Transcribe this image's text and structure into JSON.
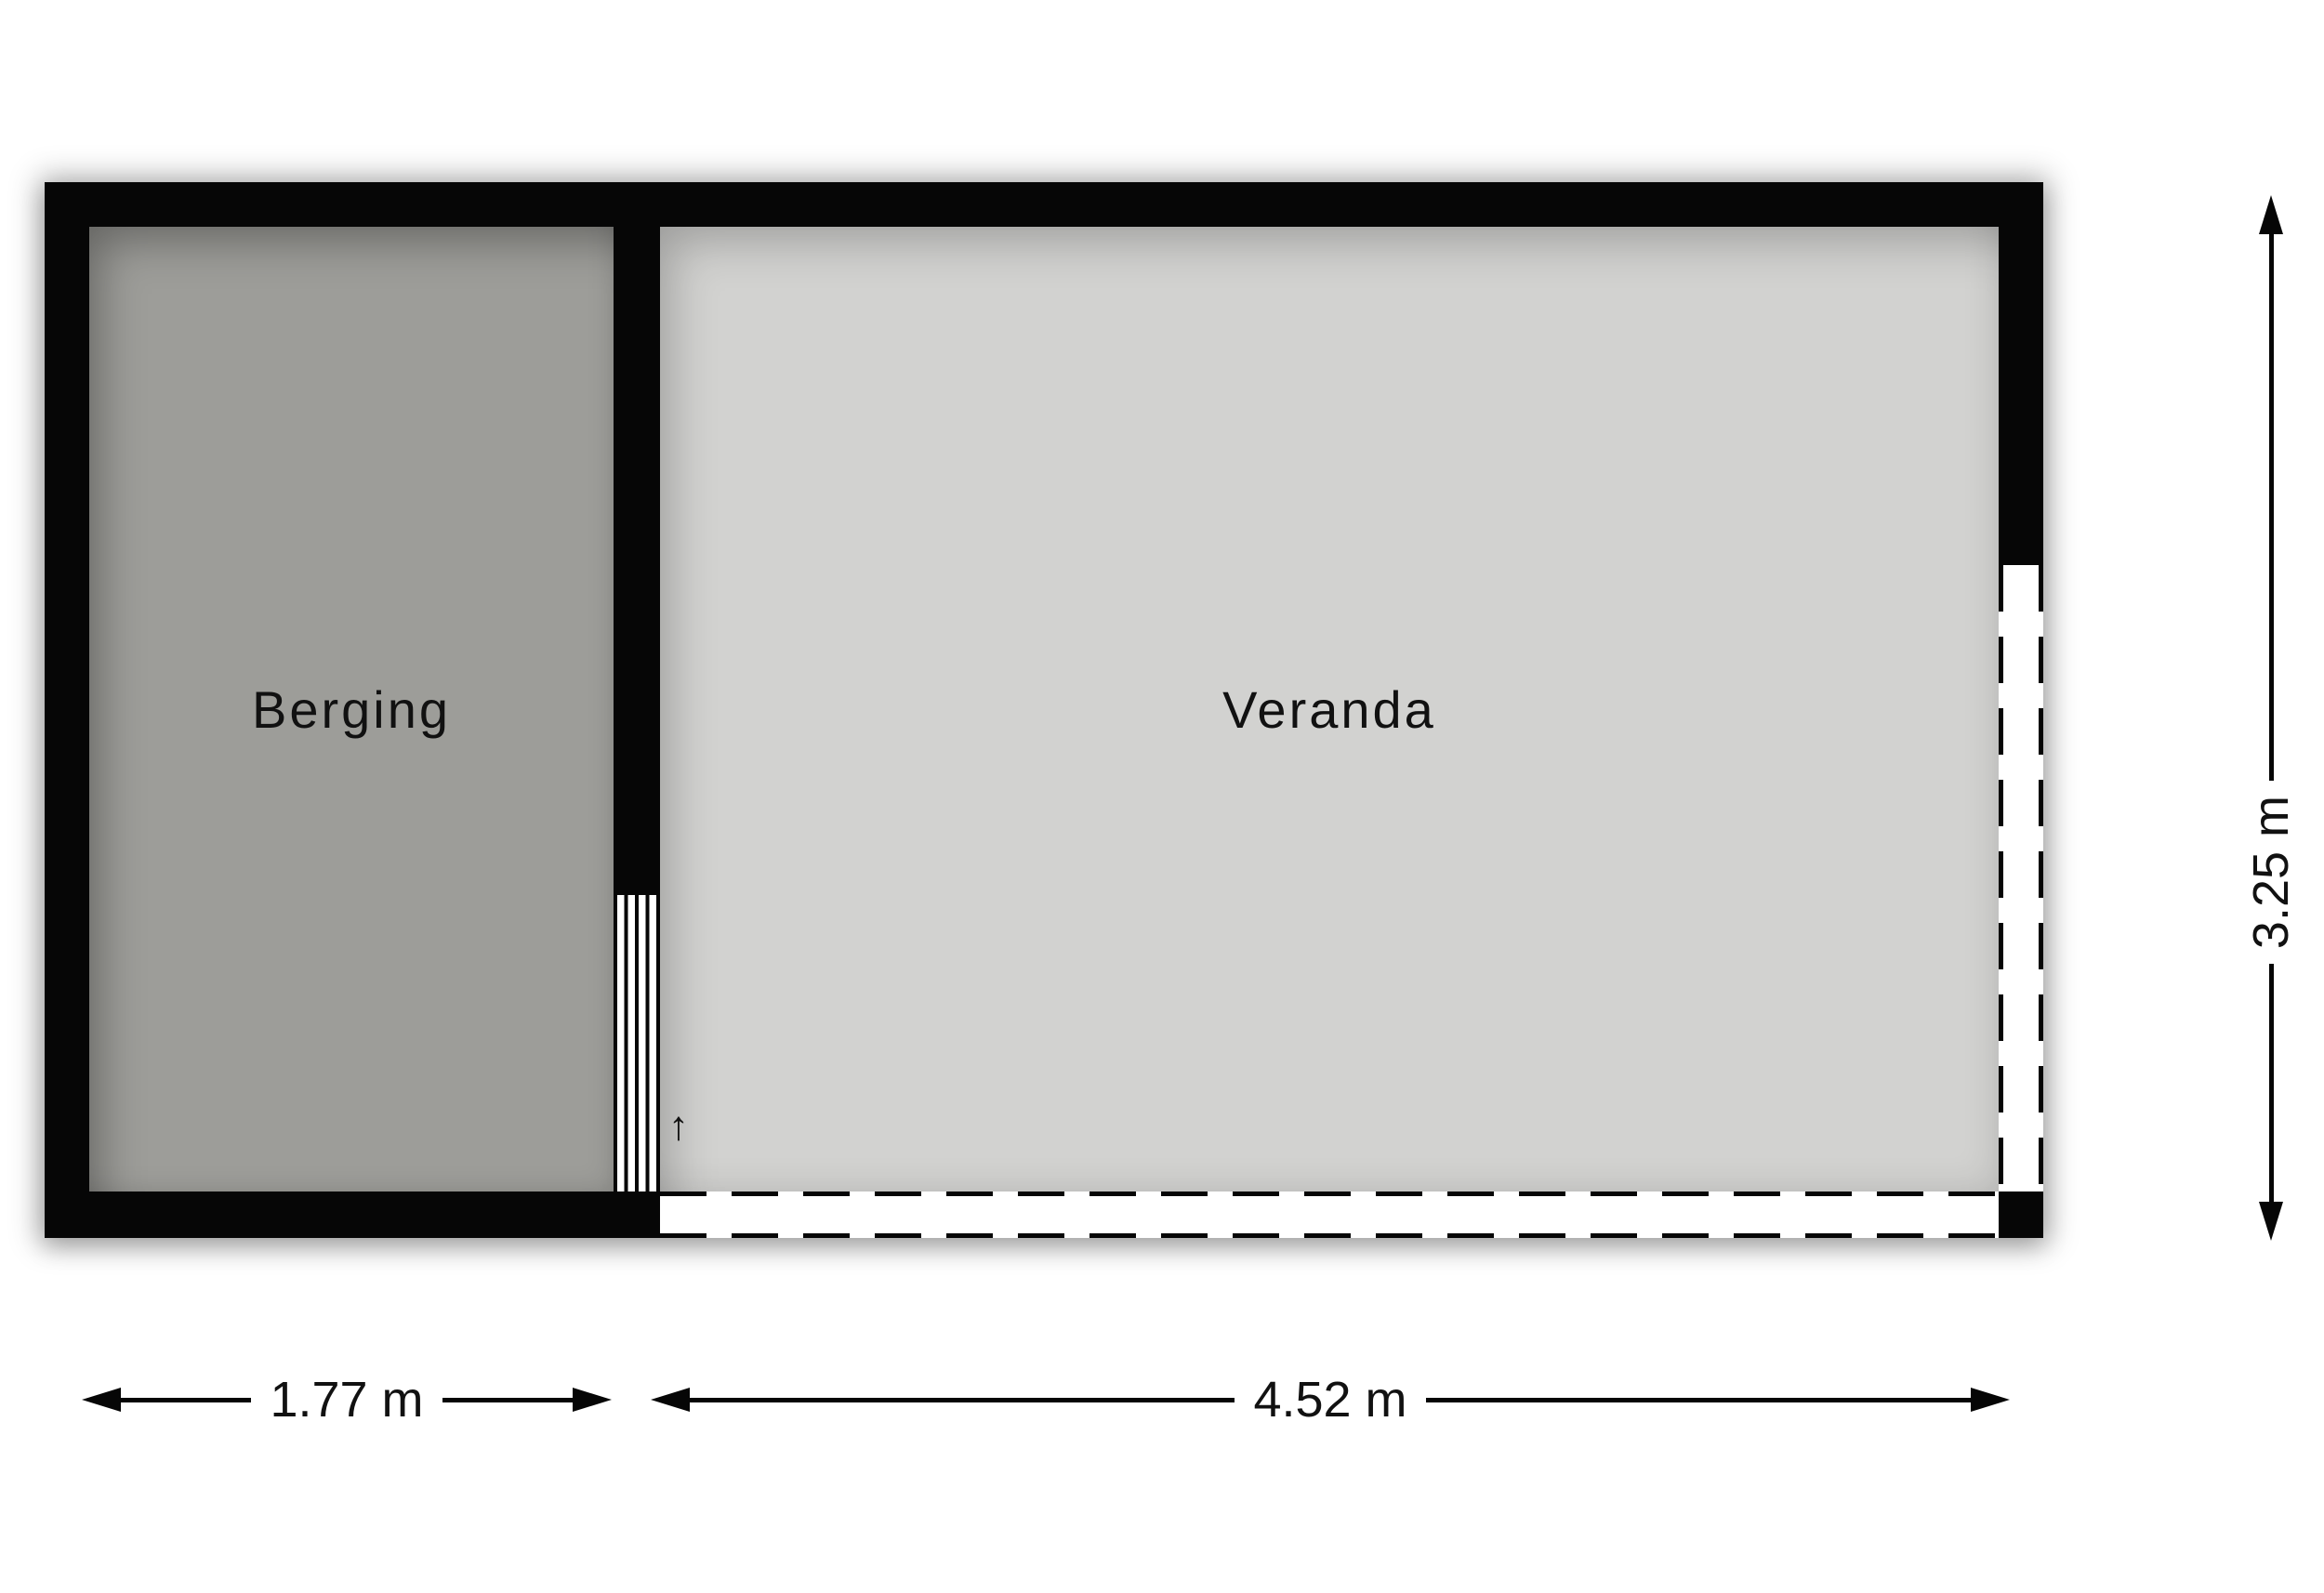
{
  "rooms": {
    "berging": {
      "label": "Berging"
    },
    "veranda": {
      "label": "Veranda"
    }
  },
  "dims": {
    "berging_width": "1.77 m",
    "veranda_width": "4.52 m",
    "veranda_depth": "3.25 m"
  },
  "icons": {
    "entrance_arrow": "↑"
  },
  "colors": {
    "wall": "#060606",
    "berging_fill": "#9d9d99",
    "veranda_fill": "#d2d2d0",
    "open_wall_fill": "#ffffff",
    "background": "#ffffff",
    "text": "#111111"
  }
}
